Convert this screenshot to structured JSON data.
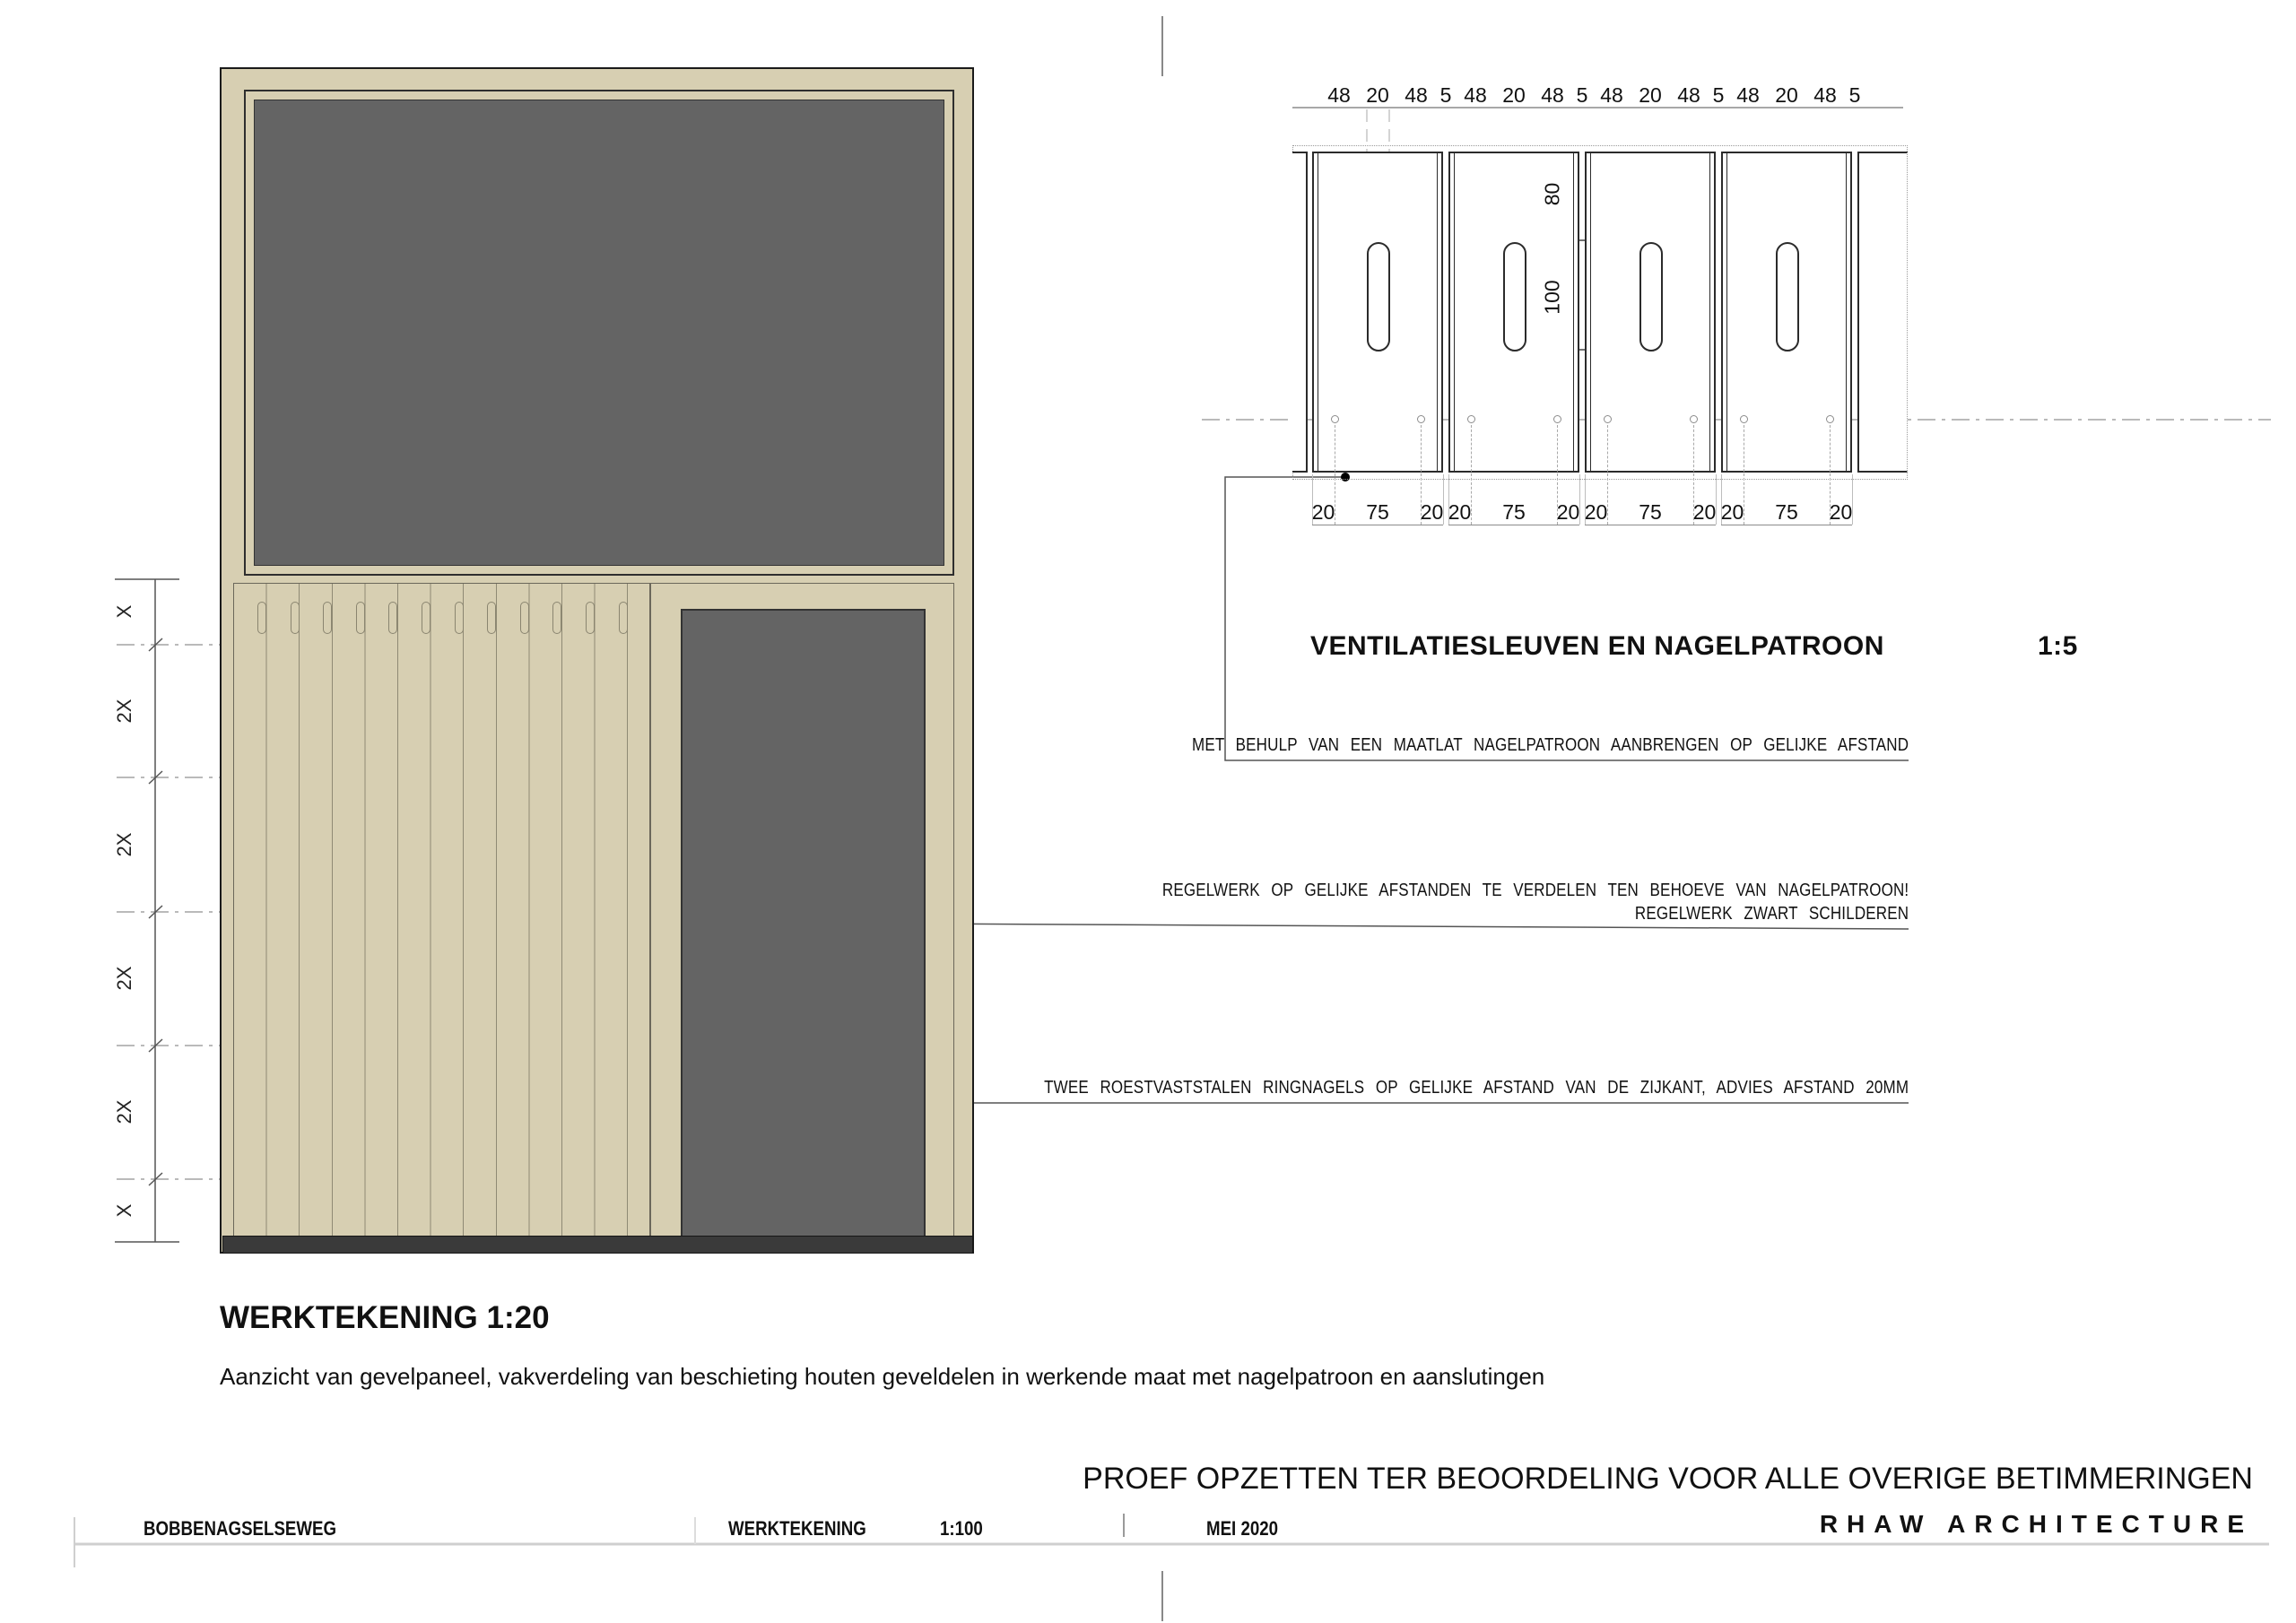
{
  "colors": {
    "wood": "#d7cfb2",
    "wood_line": "#8f8a74",
    "dark_panel": "#646464",
    "base_strip": "#3a3a3a"
  },
  "main_drawing": {
    "title": "WERKTEKENING 1:20",
    "subtitle": "Aanzicht van gevelpaneel, vakverdeling van beschieting houten geveldelen in werkende maat met nagelpatroon en aanslutingen",
    "left_dims": [
      "X",
      "2X",
      "2X",
      "2X",
      "2X",
      "X"
    ]
  },
  "detail_drawing": {
    "title": "VENTILATIESLEUVEN EN NAGELPATROON",
    "scale_label": "1:5",
    "top_dims": [
      "48",
      "20",
      "48",
      "5",
      "48",
      "20",
      "48",
      "5",
      "48",
      "20",
      "48",
      "5",
      "48",
      "20",
      "48",
      "5"
    ],
    "bottom_dims": [
      "20",
      "75",
      "20",
      "20",
      "75",
      "20",
      "20",
      "75",
      "20",
      "20",
      "75",
      "20"
    ],
    "vertical_dims": [
      "80",
      "100"
    ],
    "annotations": {
      "maatlat": "MET BEHULP VAN EEN MAATLAT NAGELPATROON AANBRENGEN OP GELIJKE AFSTAND",
      "regelwerk_verdelen": "REGELWERK OP GELIJKE AFSTANDEN TE VERDELEN TEN BEHOEVE VAN NAGELPATROON!",
      "regelwerk_zwart": "REGELWERK ZWART SCHILDEREN",
      "ringnagels": "TWEE ROESTVASTSTALEN RINGNAGELS OP GELIJKE AFSTAND VAN DE ZIJKANT, ADVIES AFSTAND 20MM"
    }
  },
  "banner": "PROEF OPZETTEN TER BEOORDELING VOOR ALLE OVERIGE BETIMMERINGEN",
  "title_bar": {
    "project": "BOBBENAGSELSEWEG",
    "doc": "WERKTEKENING",
    "scale": "1:100",
    "date": "MEI 2020",
    "firm": "RHAW ARCHITECTURE"
  }
}
